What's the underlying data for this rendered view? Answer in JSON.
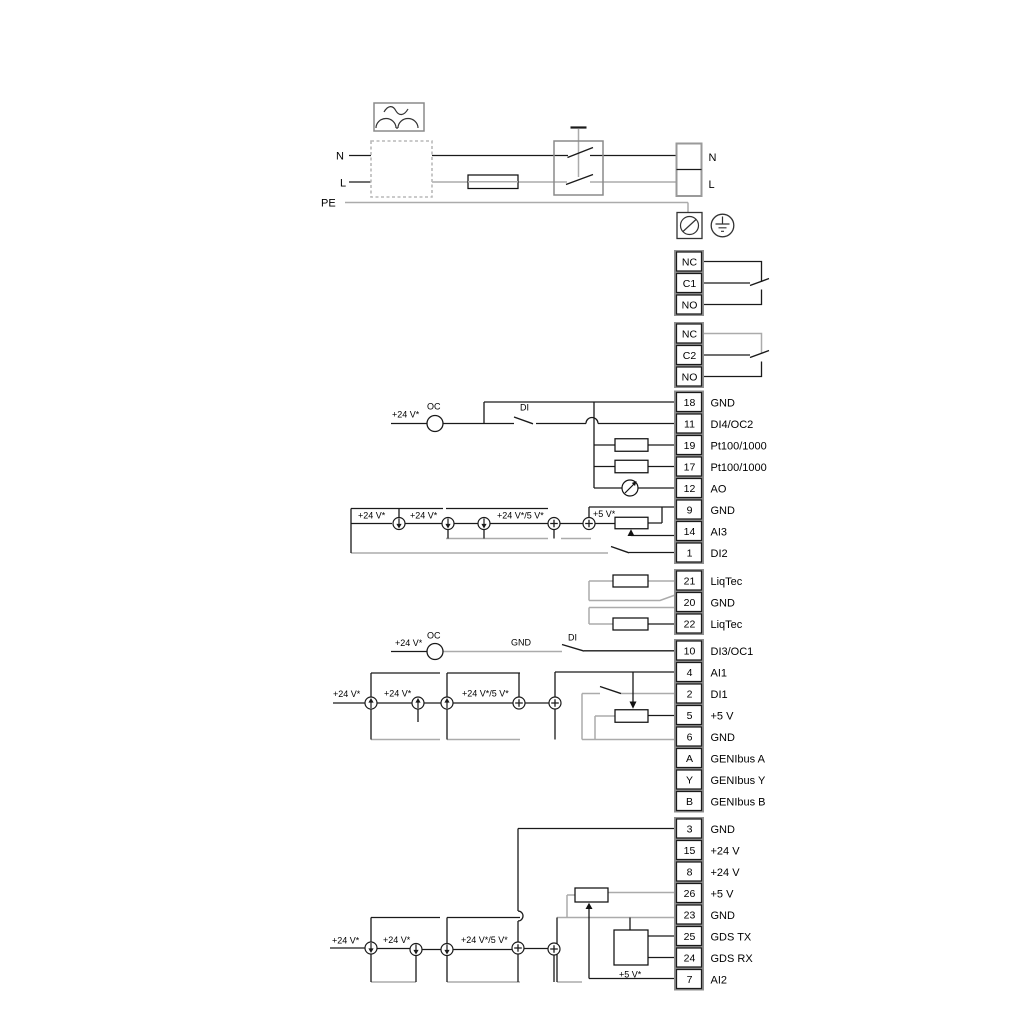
{
  "power": {
    "n_left": "N",
    "l_left": "L",
    "pe": "PE",
    "n_right": "N",
    "l_right": "L"
  },
  "relays": [
    {
      "rows": [
        "NC",
        "C1",
        "NO"
      ]
    },
    {
      "rows": [
        "NC",
        "C2",
        "NO"
      ]
    }
  ],
  "terminal_groups": [
    {
      "rows": [
        [
          "18",
          "GND"
        ],
        [
          "11",
          "DI4/OC2"
        ],
        [
          "19",
          "Pt100/1000"
        ],
        [
          "17",
          "Pt100/1000"
        ],
        [
          "12",
          "AO"
        ],
        [
          "9",
          "GND"
        ],
        [
          "14",
          "AI3"
        ],
        [
          "1",
          "DI2"
        ]
      ]
    },
    {
      "rows": [
        [
          "21",
          "LiqTec"
        ],
        [
          "20",
          "GND"
        ],
        [
          "22",
          "LiqTec"
        ]
      ]
    },
    {
      "rows": [
        [
          "10",
          "DI3/OC1"
        ],
        [
          "4",
          "AI1"
        ],
        [
          "2",
          "DI1"
        ],
        [
          "5",
          "+5 V"
        ],
        [
          "6",
          "GND"
        ],
        [
          "A",
          "GENIbus A"
        ],
        [
          "Y",
          "GENIbus Y"
        ],
        [
          "B",
          "GENIbus B"
        ]
      ]
    },
    {
      "rows": [
        [
          "3",
          "GND"
        ],
        [
          "15",
          "+24 V"
        ],
        [
          "8",
          "+24 V"
        ],
        [
          "26",
          "+5 V"
        ],
        [
          "23",
          "GND"
        ],
        [
          "25",
          "GDS TX"
        ],
        [
          "24",
          "GDS RX"
        ],
        [
          "7",
          "AI2"
        ]
      ]
    }
  ],
  "labels": {
    "plus24": "+24 V*",
    "plus24or5": "+24 V*/5 V*",
    "plus5": "+5 V*",
    "oc": "OC",
    "di": "DI",
    "gnd": "GND"
  },
  "colors": {
    "wire_black": "#1a1a1a",
    "wire_gray": "#ababab",
    "frame_gray": "#8f8f8f"
  }
}
